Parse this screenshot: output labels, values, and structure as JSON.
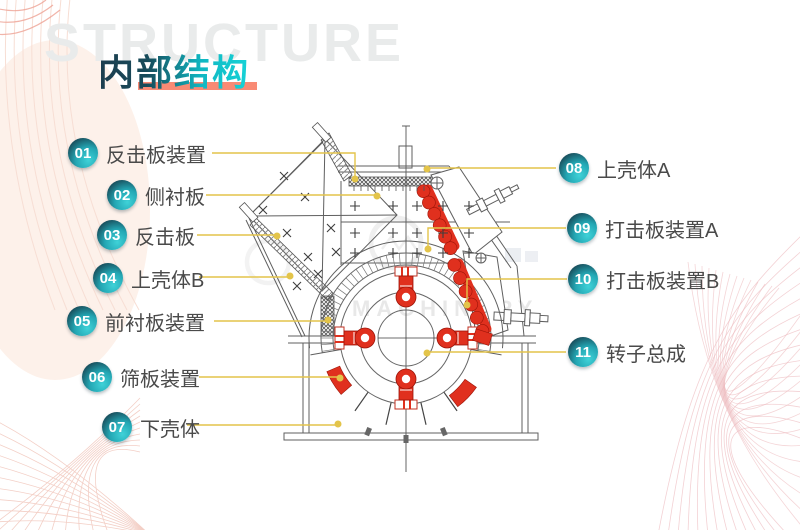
{
  "watermark": "STRUCTURE",
  "title": "内部结构",
  "diagram_watermark": "MACHINERY",
  "labels": {
    "left": [
      {
        "num": "01",
        "text": "反击板装置"
      },
      {
        "num": "02",
        "text": "侧衬板"
      },
      {
        "num": "03",
        "text": "反击板"
      },
      {
        "num": "04",
        "text": "上壳体B"
      },
      {
        "num": "05",
        "text": "前衬板装置"
      },
      {
        "num": "06",
        "text": "筛板装置"
      },
      {
        "num": "07",
        "text": "下壳体"
      }
    ],
    "right": [
      {
        "num": "08",
        "text": "上壳体A"
      },
      {
        "num": "09",
        "text": "打击板装置A"
      },
      {
        "num": "10",
        "text": "打击板装置B"
      },
      {
        "num": "11",
        "text": "转子总成"
      }
    ]
  },
  "colors": {
    "badge_dark": "#17333f",
    "badge_teal": "#2cc0c9",
    "leader_yellow": "#e3c44a",
    "part_red": "#e0301e",
    "underline_red": "#f98a74",
    "title_dark": "#1d3d4e",
    "title_teal": "#17d3d7",
    "watermark_gray": "#e9ebeb",
    "label_text": "#4a4a4a"
  }
}
